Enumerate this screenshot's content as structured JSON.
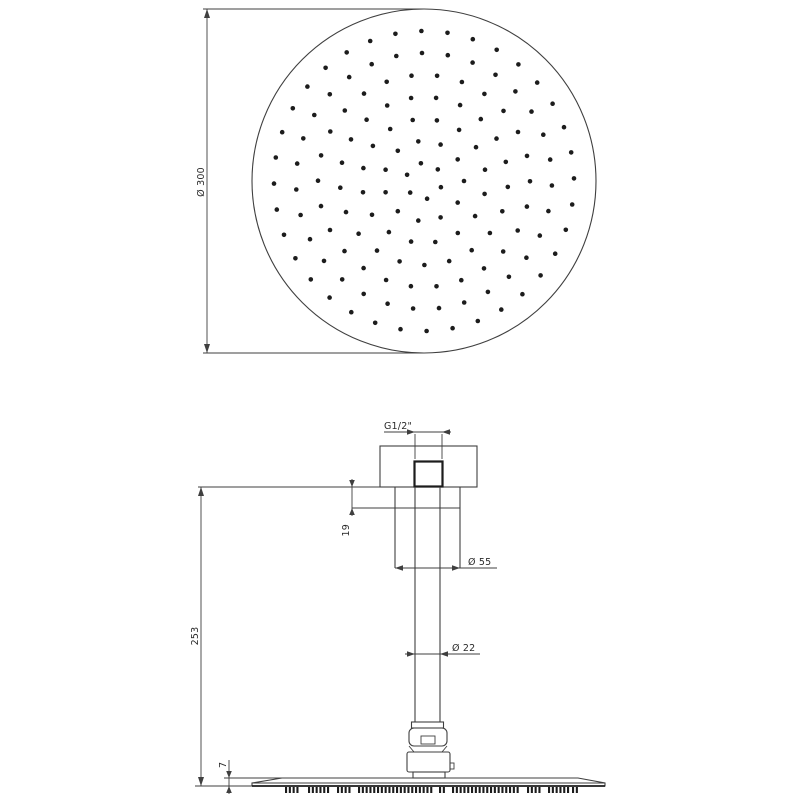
{
  "labels": {
    "top_diameter": "Ø 300",
    "thread": "G1/2\"",
    "ceiling_inset": "19",
    "flange_diameter": "Ø 55",
    "drop_height": "253",
    "pipe_diameter": "Ø 22",
    "plate_thickness": "7"
  },
  "colors": {
    "line": "#3f3f3f",
    "dark": "#1c1c1c",
    "background": "#ffffff"
  },
  "top_view": {
    "description": "shower head face with nozzle pattern",
    "center_x": 424,
    "center_y": 181,
    "face_radius": 172,
    "dot_radius": 2.3,
    "nozzle_rings": [
      {
        "r": 18,
        "n": 6,
        "a0": 20
      },
      {
        "r": 40,
        "n": 11,
        "a0": 0
      },
      {
        "r": 62,
        "n": 16,
        "a0": 12
      },
      {
        "r": 84,
        "n": 21,
        "a0": 4
      },
      {
        "r": 106,
        "n": 26,
        "a0": 14
      },
      {
        "r": 128,
        "n": 31,
        "a0": 2
      },
      {
        "r": 150,
        "n": 36,
        "a0": 9
      }
    ]
  },
  "side_view": {
    "description": "ceiling-mounted shower arm section",
    "teeth_y": 787,
    "teeth_h": 6,
    "teeth_groups": [
      [
        285,
        16
      ],
      [
        308,
        23
      ],
      [
        337,
        15
      ],
      [
        358,
        75
      ],
      [
        439,
        8
      ],
      [
        452,
        69
      ],
      [
        527,
        15
      ],
      [
        548,
        21
      ],
      [
        572,
        7
      ]
    ]
  }
}
